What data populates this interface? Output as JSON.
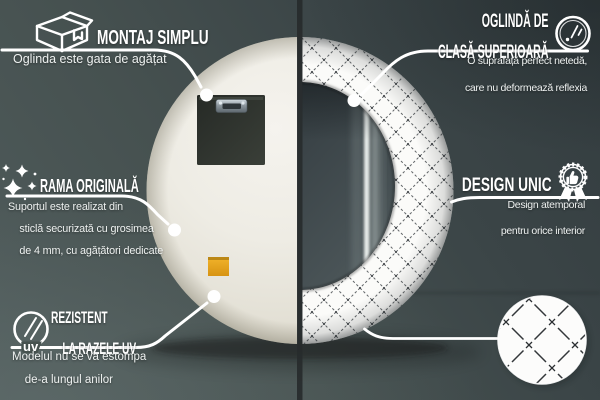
{
  "callouts": {
    "montaj_simplu": {
      "title": "MONTAJ SIMPLU",
      "subtitle": "Oglinda este gata de agățat",
      "icon": "package-box-icon"
    },
    "rama_originala": {
      "title": "RAMA ORIGINALĂ",
      "lines": [
        "Suportul este realizat din",
        "sticlă securizată cu grosimea",
        "de 4 mm, cu agățători dedicate"
      ],
      "icon": "sparkles-icon"
    },
    "rezistent_uv": {
      "title_lines": [
        "REZISTENT",
        "LA RAZELE UV"
      ],
      "lines": [
        "Modelul nu se va estompa",
        "de-a lungul anilor"
      ],
      "icon_label": "uv",
      "icon": "uv-no-fade-icon"
    },
    "oglinda_superioara": {
      "title_lines": [
        "OGLINDĂ DE",
        "CLASĂ SUPERIOARĂ"
      ],
      "lines": [
        "O suprafață perfect netedă,",
        "care nu deformează reflexia"
      ],
      "icon": "mirror-shine-icon"
    },
    "design_unic": {
      "title": "DESIGN UNIC",
      "lines": [
        "Design atemporal",
        "pentru orice interior"
      ],
      "icon": "award-badge-icon"
    }
  },
  "product": {
    "left_half": "mirror back with mounting plate",
    "right_half": "round mirror front with diamond lattice frame",
    "swatch": "frame pattern close-up"
  },
  "colors": {
    "background_dark": "#333c3f",
    "background_light": "#505c5c",
    "divider": "#272b2d",
    "mirror_back": "#efede5",
    "frame_white": "#fbfbf9",
    "pattern_line": "#5a5e61",
    "glass_dark": "#333c40",
    "glass_light": "#525c5f",
    "sticker_orange": "#e6a41f",
    "callout_white": "#ffffff"
  }
}
